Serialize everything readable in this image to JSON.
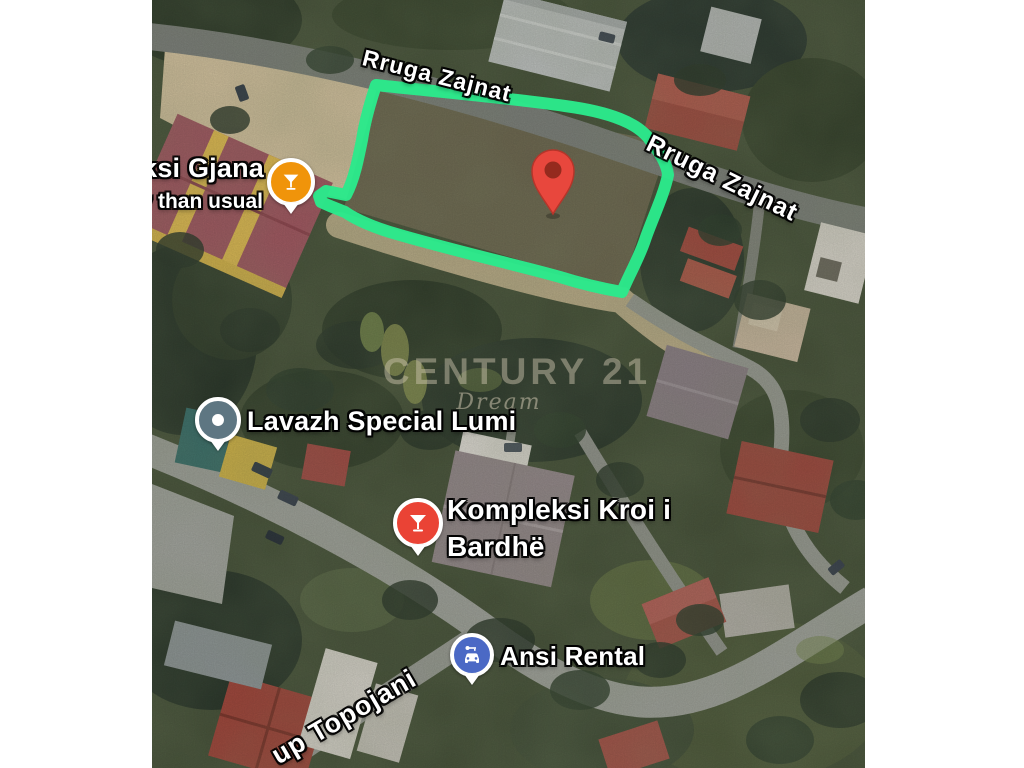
{
  "watermark": {
    "brand": "CENTURY 21",
    "sub": "Dream"
  },
  "roads": {
    "top": "Rruga Zajnat",
    "right": "Rruga Zajnat",
    "bottom": "up Topojani"
  },
  "pois": {
    "gjana": {
      "name": "ksi Gjana",
      "status": "y than usual"
    },
    "lavazh": {
      "name": "Lavazh Special Lumi"
    },
    "kroi": {
      "name_line1": "Kompleksi Kroi i",
      "name_line2": "Bardhë"
    },
    "ansi": {
      "name": "Ansi Rental"
    }
  },
  "colors": {
    "boundary_green": "#2be98b",
    "marker_red": "#e8473d",
    "marker_red_inner": "#952a1e",
    "pin_gjana_orange": "#f0940a",
    "pin_lavazh_slate": "#5e7682",
    "pin_kroi_red": "#ea4335",
    "pin_ansi_blue": "#4b69c5"
  }
}
